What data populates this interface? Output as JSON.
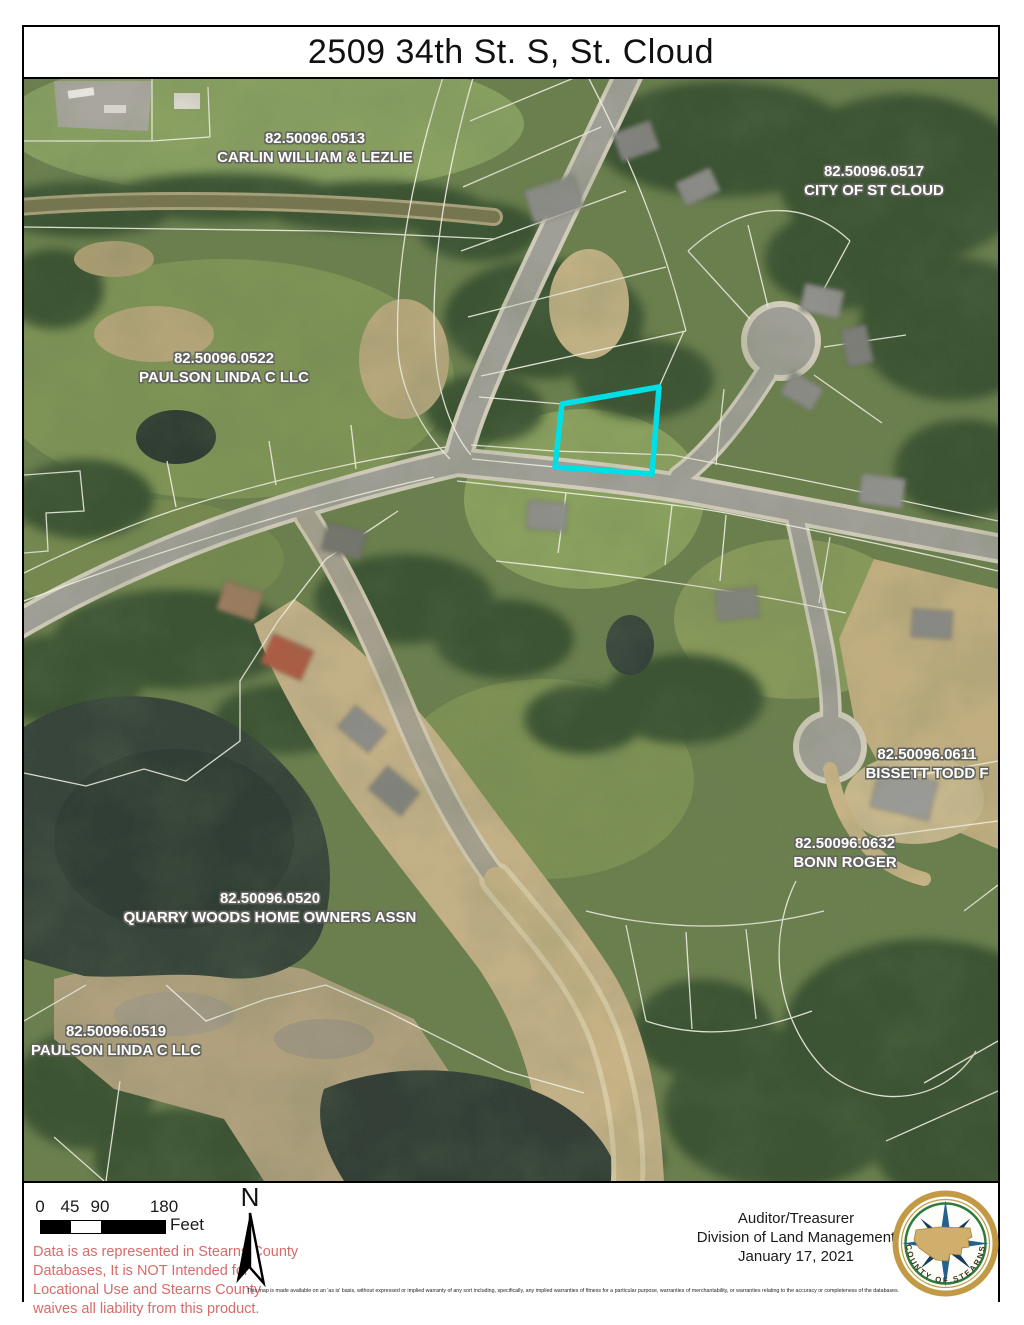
{
  "title": "2509 34th St. S, St. Cloud",
  "map": {
    "highlight_color": "#00dfe6",
    "parcel_line_color": "#f2f1e4",
    "parcel_labels": [
      {
        "id": "82.50096.0513",
        "owner": "CARLIN WILLIAM & LEZLIE",
        "x": 291,
        "y": 69
      },
      {
        "id": "82.50096.0517",
        "owner": "CITY OF ST CLOUD",
        "x": 850,
        "y": 102
      },
      {
        "id": "82.50096.0522",
        "owner": "PAULSON LINDA C LLC",
        "x": 200,
        "y": 289
      },
      {
        "id": "82.50096.0611",
        "owner": "BISSETT TODD F",
        "x": 903,
        "y": 685
      },
      {
        "id": "82.50096.0632",
        "owner": "BONN ROGER",
        "x": 821,
        "y": 774
      },
      {
        "id": "82.50096.0520",
        "owner": "QUARRY WOODS HOME OWNERS ASSN",
        "x": 246,
        "y": 829
      },
      {
        "id": "82.50096.0519",
        "owner": "PAULSON LINDA C LLC",
        "x": 92,
        "y": 962
      }
    ]
  },
  "footer": {
    "scale_bar": {
      "labels": [
        "0",
        "45",
        "90",
        "180"
      ],
      "unit": "Feet"
    },
    "north_label": "N",
    "disclaimer_red": [
      "Data is as represented in Stearns County",
      "Databases, It is NOT Intended for",
      "Locational Use and Stearns County",
      "waives all liability from this product."
    ],
    "disclaimer_fine": "This map is made available on an 'as is' basis, without expressed or implied warranty of any sort including, specifically, any implied warranties of fitness for a particular purpose, warranties of merchantability, or warranties relating to the accuracy or completeness of the databases.",
    "credit": {
      "line1": "Auditor/Treasurer",
      "line2": "Division of Land Management",
      "line3": "January 17, 2021"
    },
    "seal_text": "COUNTY OF STEARNS"
  }
}
